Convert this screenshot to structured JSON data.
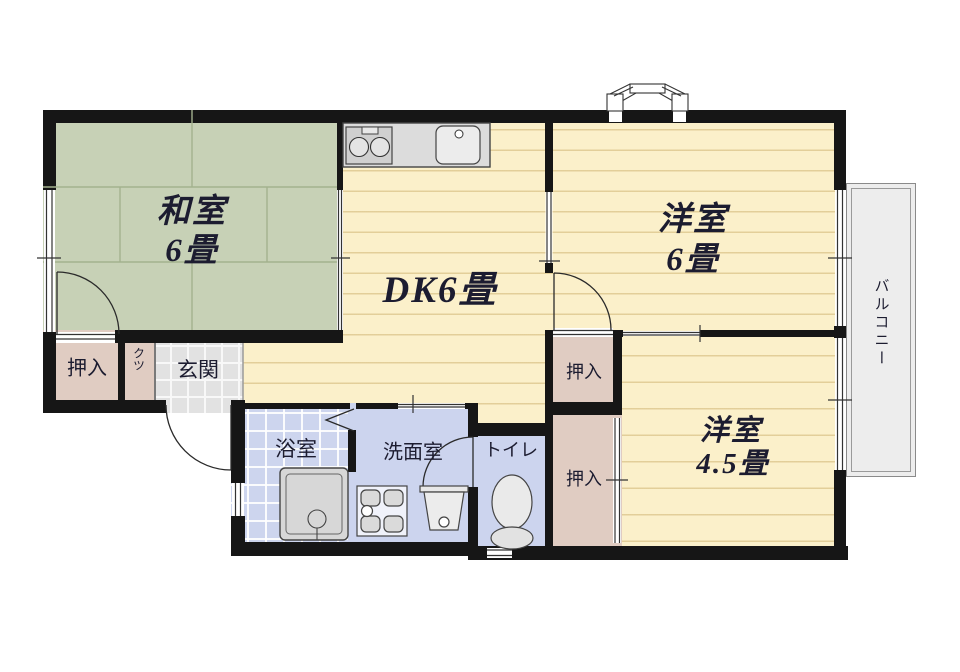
{
  "plan": {
    "rooms": {
      "washitsu": {
        "label": "和室",
        "size": "6畳"
      },
      "dk": {
        "label": "DK6畳"
      },
      "yoshitsu6": {
        "label": "洋室",
        "size": "6畳"
      },
      "yoshitsu45": {
        "label": "洋室",
        "size": "4.5畳"
      },
      "genkan": {
        "label": "玄関"
      },
      "bathroom": {
        "label": "浴室"
      },
      "washroom": {
        "label": "洗面室"
      },
      "toilet": {
        "label": "トイレ"
      },
      "balcony": {
        "label": "バルコニー"
      },
      "closet_left": {
        "label": "押入"
      },
      "closet_mid_top": {
        "label": "押入"
      },
      "closet_mid_bottom": {
        "label": "押入"
      },
      "shoe_box": {
        "label": "クツ"
      }
    },
    "colors": {
      "wall": "#161616",
      "tatami_green": "#c7d1b6",
      "flooring_cream": "#fbf0ca",
      "closet_pink": "#e0ccc2",
      "wet_area_blue": "#ccd4ee",
      "genkan_tile_gray": "#e2e2e2",
      "balcony_gray": "#ededed",
      "label_ink": "#1c1c30"
    }
  }
}
